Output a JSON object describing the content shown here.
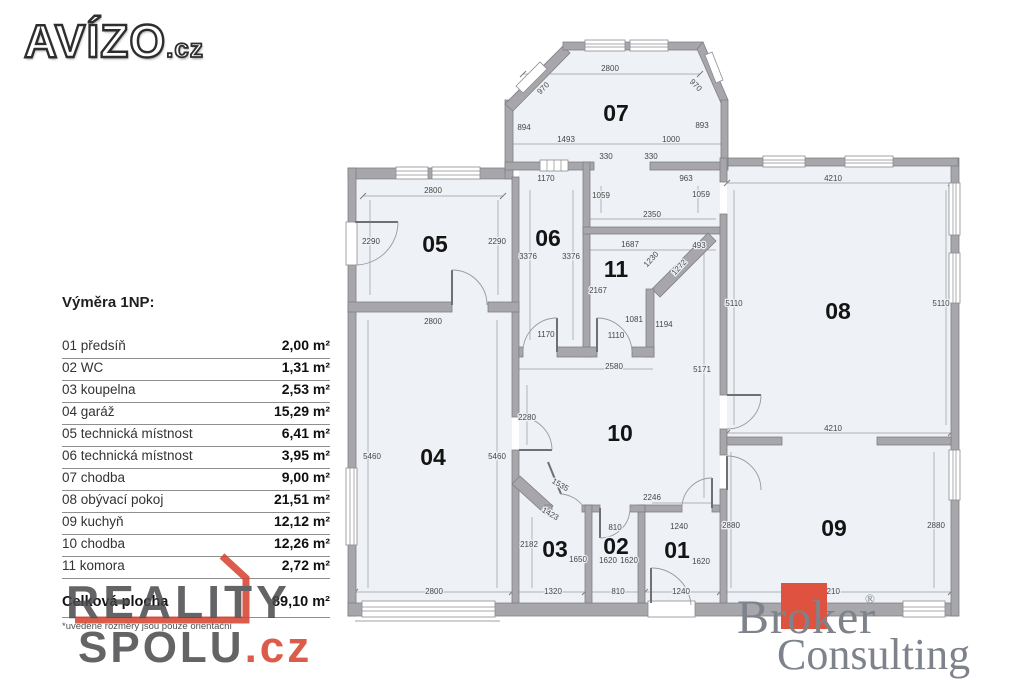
{
  "branding": {
    "avizo": {
      "text": "AVÍZO",
      "suffix": ".cz"
    },
    "reality_spolu": {
      "line1": "REALITY",
      "line2": "SPOLU",
      "suffix": ".cz"
    },
    "broker": {
      "line1": "Broker",
      "reg": "®",
      "line2": "Consulting"
    }
  },
  "area_table": {
    "title": "Výměra 1NP:",
    "rows": [
      {
        "name": "01 předsíň",
        "value": "2,00 m²"
      },
      {
        "name": "02 WC",
        "value": "1,31 m²"
      },
      {
        "name": "03 koupelna",
        "value": "2,53 m²"
      },
      {
        "name": "04 garáž",
        "value": "15,29 m²"
      },
      {
        "name": "05 technická místnost",
        "value": "6,41 m²"
      },
      {
        "name": "06 technická místnost",
        "value": "3,95 m²"
      },
      {
        "name": "07 chodba",
        "value": "9,00 m²"
      },
      {
        "name": "08 obývací pokoj",
        "value": "21,51 m²"
      },
      {
        "name": "09 kuchyň",
        "value": "12,12 m²"
      },
      {
        "name": "10 chodba",
        "value": "12,26 m²"
      },
      {
        "name": "11 komora",
        "value": "2,72 m²"
      }
    ],
    "total": {
      "name": "Celková plocha",
      "value": "89,10 m²"
    },
    "note": "*uvedené rozměry jsou pouze orientační"
  },
  "plan": {
    "room_labels": [
      {
        "id": "07",
        "x": 616,
        "y": 121
      },
      {
        "id": "05",
        "x": 435,
        "y": 252
      },
      {
        "id": "06",
        "x": 548,
        "y": 246
      },
      {
        "id": "11",
        "x": 616,
        "y": 277
      },
      {
        "id": "08",
        "x": 838,
        "y": 319
      },
      {
        "id": "04",
        "x": 433,
        "y": 465
      },
      {
        "id": "10",
        "x": 620,
        "y": 441
      },
      {
        "id": "03",
        "x": 555,
        "y": 557
      },
      {
        "id": "02",
        "x": 616,
        "y": 554
      },
      {
        "id": "01",
        "x": 677,
        "y": 558
      },
      {
        "id": "09",
        "x": 834,
        "y": 536
      }
    ],
    "dim_labels": [
      {
        "t": "2800",
        "x": 610,
        "y": 71
      },
      {
        "t": "970",
        "x": 545,
        "y": 90,
        "r": -45
      },
      {
        "t": "970",
        "x": 694,
        "y": 87,
        "r": 45
      },
      {
        "t": "894",
        "x": 524,
        "y": 130
      },
      {
        "t": "893",
        "x": 702,
        "y": 128
      },
      {
        "t": "1493",
        "x": 566,
        "y": 142
      },
      {
        "t": "1000",
        "x": 671,
        "y": 142
      },
      {
        "t": "330",
        "x": 606,
        "y": 159
      },
      {
        "t": "330",
        "x": 651,
        "y": 159
      },
      {
        "t": "1170",
        "x": 546,
        "y": 181
      },
      {
        "t": "963",
        "x": 686,
        "y": 181
      },
      {
        "t": "1059",
        "x": 601,
        "y": 198
      },
      {
        "t": "1059",
        "x": 701,
        "y": 197
      },
      {
        "t": "2350",
        "x": 652,
        "y": 217
      },
      {
        "t": "1687",
        "x": 630,
        "y": 247
      },
      {
        "t": "493",
        "x": 699,
        "y": 248
      },
      {
        "t": "1230",
        "x": 653,
        "y": 261,
        "r": -48
      },
      {
        "t": "1272",
        "x": 681,
        "y": 269,
        "r": -48
      },
      {
        "t": "3376",
        "x": 528,
        "y": 259
      },
      {
        "t": "3376",
        "x": 571,
        "y": 259
      },
      {
        "t": "2167",
        "x": 598,
        "y": 293
      },
      {
        "t": "1081",
        "x": 634,
        "y": 322
      },
      {
        "t": "1194",
        "x": 664,
        "y": 327
      },
      {
        "t": "1170",
        "x": 546,
        "y": 337
      },
      {
        "t": "1110",
        "x": 616,
        "y": 338
      },
      {
        "t": "2580",
        "x": 614,
        "y": 369
      },
      {
        "t": "5171",
        "x": 702,
        "y": 372
      },
      {
        "t": "4210",
        "x": 833,
        "y": 181
      },
      {
        "t": "5110",
        "x": 734,
        "y": 306
      },
      {
        "t": "5110",
        "x": 941,
        "y": 306
      },
      {
        "t": "2800",
        "x": 433,
        "y": 193
      },
      {
        "t": "2290",
        "x": 371,
        "y": 244
      },
      {
        "t": "2290",
        "x": 497,
        "y": 244
      },
      {
        "t": "2800",
        "x": 433,
        "y": 324
      },
      {
        "t": "5460",
        "x": 372,
        "y": 459
      },
      {
        "t": "5460",
        "x": 497,
        "y": 459
      },
      {
        "t": "2280",
        "x": 527,
        "y": 420
      },
      {
        "t": "1535",
        "x": 559,
        "y": 487,
        "r": 30
      },
      {
        "t": "1423",
        "x": 549,
        "y": 516,
        "r": 30
      },
      {
        "t": "2246",
        "x": 652,
        "y": 500
      },
      {
        "t": "810",
        "x": 615,
        "y": 530
      },
      {
        "t": "1240",
        "x": 679,
        "y": 529
      },
      {
        "t": "2880",
        "x": 731,
        "y": 528
      },
      {
        "t": "2880",
        "x": 936,
        "y": 528
      },
      {
        "t": "4210",
        "x": 833,
        "y": 431
      },
      {
        "t": "2182",
        "x": 529,
        "y": 547
      },
      {
        "t": "1650",
        "x": 578,
        "y": 562
      },
      {
        "t": "1620",
        "x": 608,
        "y": 563
      },
      {
        "t": "1620",
        "x": 629,
        "y": 563
      },
      {
        "t": "1620",
        "x": 701,
        "y": 564
      },
      {
        "t": "2800",
        "x": 434,
        "y": 594
      },
      {
        "t": "1320",
        "x": 553,
        "y": 594
      },
      {
        "t": "810",
        "x": 618,
        "y": 594
      },
      {
        "t": "1240",
        "x": 681,
        "y": 594
      },
      {
        "t": "4210",
        "x": 831,
        "y": 594
      }
    ]
  },
  "colors": {
    "accent_red": "#d7402d",
    "broker_red": "#df5240",
    "wall_gray": "#a7a7ab",
    "room_fill": "#eef1f5",
    "logo_gray": "#4a4a4c",
    "broker_gray": "#7e838b"
  }
}
